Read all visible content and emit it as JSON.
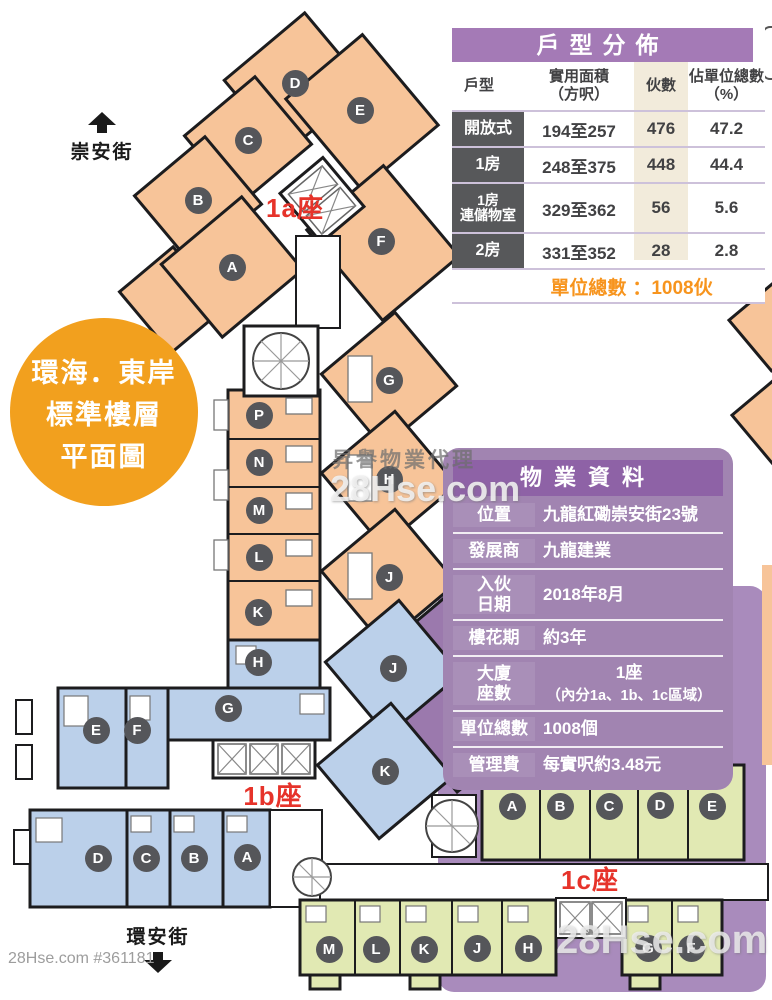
{
  "streets": {
    "top": {
      "label": "崇安街"
    },
    "bottom": {
      "label": "環安街"
    }
  },
  "badge": {
    "line1": "環海．東岸",
    "line2": "標準樓層",
    "line3": "平面圖"
  },
  "blocks": {
    "b1a": {
      "label": "1a座",
      "units": [
        "A",
        "B",
        "C",
        "D",
        "E",
        "F",
        "G",
        "H",
        "J",
        "K",
        "L",
        "M",
        "N",
        "P"
      ]
    },
    "b1b": {
      "label": "1b座",
      "units": [
        "A",
        "B",
        "C",
        "D",
        "E",
        "F",
        "G",
        "H",
        "J",
        "K"
      ]
    },
    "b1c": {
      "label": "1c座",
      "units": [
        "A",
        "B",
        "C",
        "D",
        "E",
        "F",
        "G",
        "H",
        "J",
        "K",
        "L",
        "M"
      ]
    }
  },
  "unit_table": {
    "title": "戶型分佈",
    "col_type": "戶型",
    "col_area": "實用面積\n（方呎）",
    "col_count": "伙數",
    "col_pct": "佔單位總數\n（%）",
    "rows": [
      {
        "type": "開放式",
        "area": "194至257",
        "count": "476",
        "pct": "47.2"
      },
      {
        "type": "1房",
        "area": "248至375",
        "count": "448",
        "pct": "44.4"
      },
      {
        "type": "1房\n連儲物室",
        "area": "329至362",
        "count": "56",
        "pct": "5.6"
      },
      {
        "type": "2房",
        "area": "331至352",
        "count": "28",
        "pct": "2.8"
      }
    ],
    "total_label": "單位總數",
    "total_value": "：1008伙"
  },
  "property_panel": {
    "title": "物業資料",
    "rows": [
      {
        "label": "位置",
        "value": "九龍紅磡崇安街23號"
      },
      {
        "label": "發展商",
        "value": "九龍建業"
      },
      {
        "label": "入伙\n日期",
        "value": "2018年8月"
      },
      {
        "label": "樓花期",
        "value": "約3年"
      },
      {
        "label": "大廈\n座數",
        "value": "1座",
        "value2": "（內分1a、1b、1c區域）"
      },
      {
        "label": "單位總數",
        "value": "1008個"
      },
      {
        "label": "管理費",
        "value": "每實呎約3.48元"
      }
    ]
  },
  "watermarks": {
    "bottom_left": "28Hse.com #361181",
    "agency": "昇譽物業代理",
    "center_site": "28Hse.com",
    "bottom_right_site": "28Hse.com"
  },
  "colors": {
    "block_1a_fill": "#F7C499",
    "block_1b_fill": "#BBD0EA",
    "block_1c_fill": "#E1E9B3",
    "purple_band": "#A98BBC",
    "panel_bg": "#A184B1",
    "panel_header": "#8E62A6",
    "table_header": "#A47AB6",
    "dark_label": "#57585A",
    "cream_stripe": "#F2EBDB",
    "accent_orange": "#F7941D",
    "accent_red": "#E6332A",
    "wall": "#1C1C1E"
  }
}
